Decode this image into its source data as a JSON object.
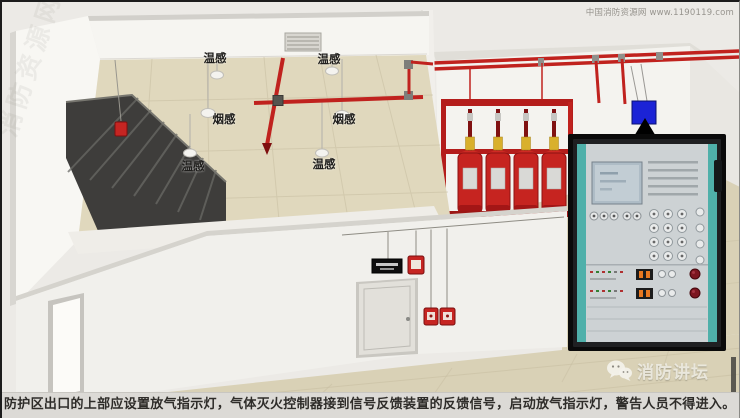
{
  "watermarks": {
    "top_right": "中国消防资源网 www.1190119.com",
    "side": "消防资源网",
    "bottom_right": "消防讲坛"
  },
  "scene": {
    "sensor_labels": [
      {
        "text": "温感"
      },
      {
        "text": "温感"
      },
      {
        "text": "烟感"
      },
      {
        "text": "烟感"
      },
      {
        "text": "温感"
      },
      {
        "text": "温感"
      }
    ],
    "equipment": {
      "cylinder_count": 4
    }
  },
  "caption": {
    "text": "防护区出口的上部应设置放气指示灯，气体灭火控制器接到信号反馈装置的反馈信号，启动放气指示灯，警告人员不得进入。"
  },
  "colors": {
    "pipe_red": "#c0221e",
    "cylinder_red": "#c62420",
    "panel_teal": "#4fb0aa",
    "indicator_box_blue": "#1b23d6",
    "floor_tan": "#d9d1b6",
    "caption_bg": "#dcdad6"
  }
}
